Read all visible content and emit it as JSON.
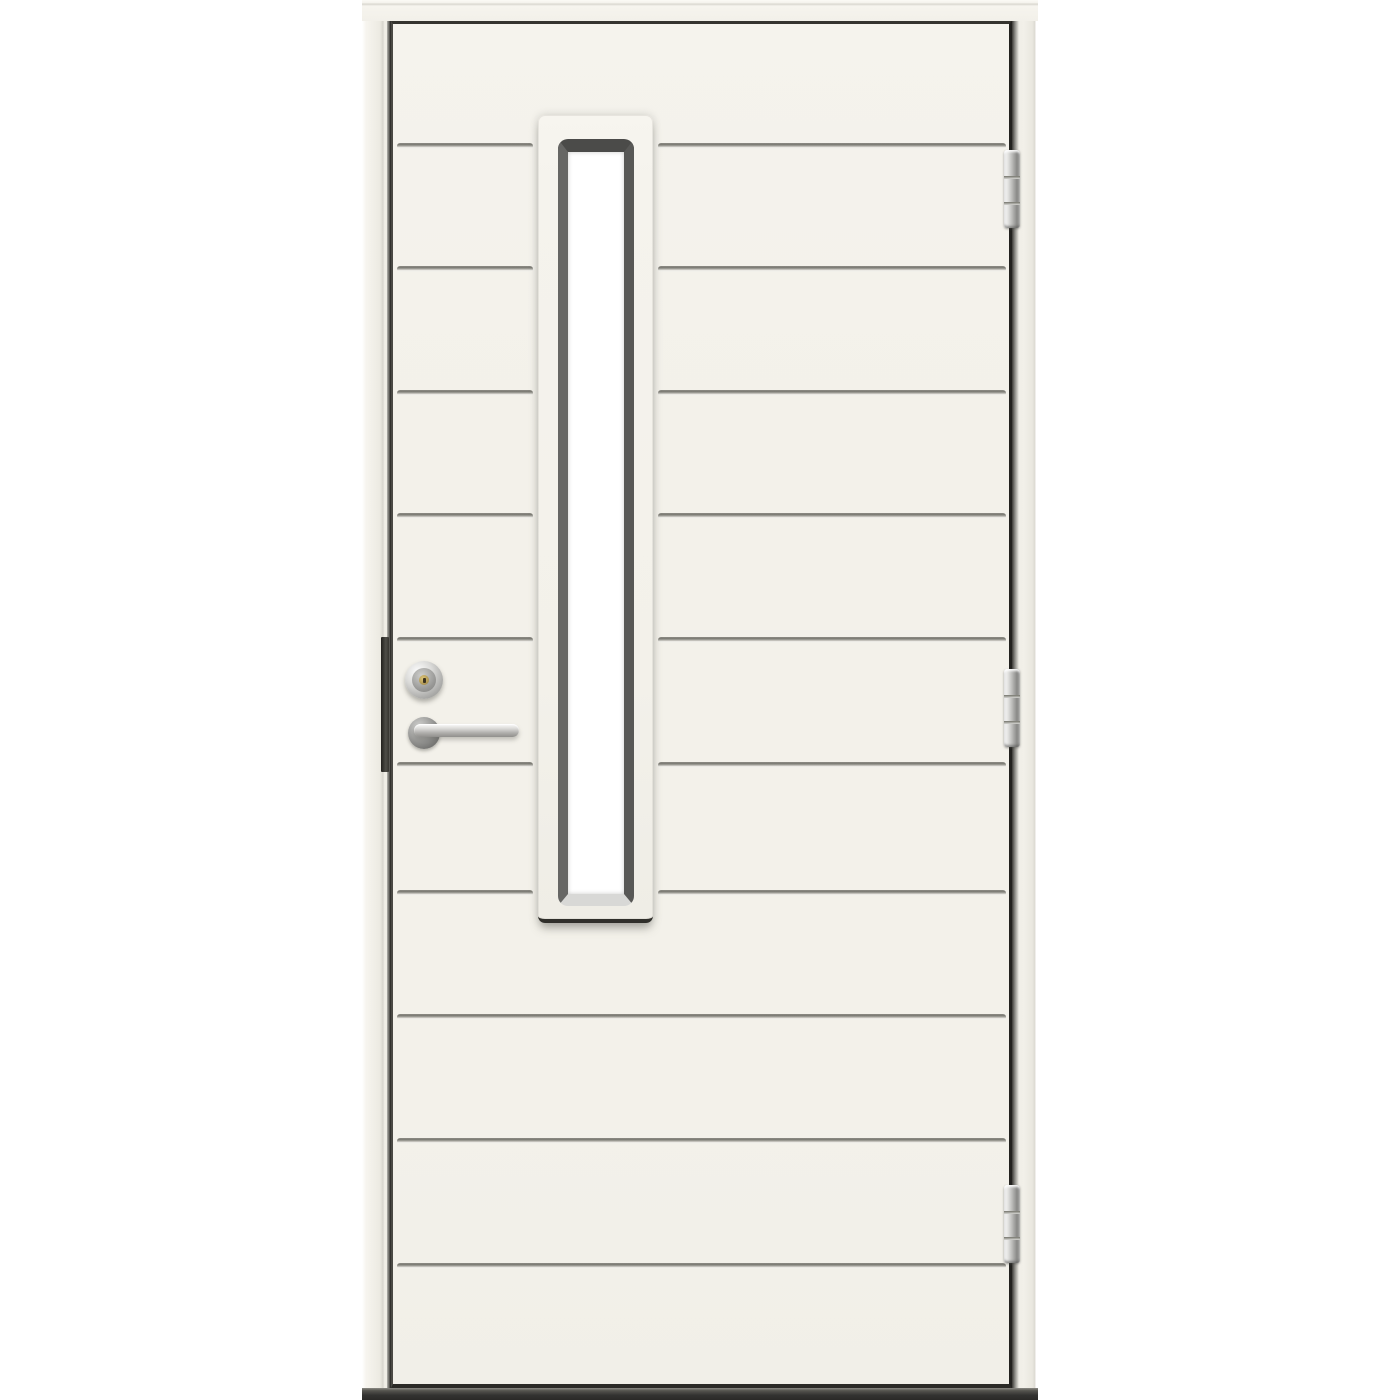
{
  "scene": {
    "description": "White exterior front door, front view: eleven horizontal grooved boards, tall narrow vertical glazing strip left of center, chrome lock cylinder and lever handle on the left side, three chrome barrel hinges on the right edge, cream door frame and dark threshold on white background",
    "background_color": "#ffffff"
  },
  "palette": {
    "background": "#ffffff",
    "door_face": "#f3f1ea",
    "door_face_shade": "#edebe4",
    "frame_face": "#f2f0e9",
    "frame_line": "#d8d6ce",
    "edge_dark": "#2e2d29",
    "gap_dark": "#1f1e1b",
    "groove_dark": "#7c7b74",
    "groove_light": "#f8f7f2",
    "surround_face": "#f5f3ed",
    "surround_edge_dark": "#302f2b",
    "bevel_top": "#4b4b49",
    "bevel_left": "#666664",
    "bevel_right": "#585856",
    "bevel_bottom": "#d8d8d6",
    "glass": "#ffffff",
    "chrome_hi": "#fbfbfb",
    "chrome_mid": "#b4b4b2",
    "chrome_dark": "#8a8a88",
    "rosette_dark": "#767674",
    "brass": "#b39a55",
    "keyhole_dark": "#3a3220",
    "threshold_dark": "#2a2927",
    "threshold_mid": "#55544f"
  },
  "door": {
    "frame_head": {
      "x": 362,
      "y": 0,
      "width": 676,
      "height": 21
    },
    "frame_left": {
      "x": 362,
      "y": 0,
      "width": 29,
      "height": 1400
    },
    "frame_right": {
      "x": 1012,
      "y": 0,
      "width": 26,
      "height": 1400
    },
    "threshold": {
      "x": 362,
      "y": 1388,
      "width": 676,
      "height": 12
    },
    "leaf": {
      "x": 391,
      "y": 21,
      "width": 621,
      "height": 1367
    },
    "board_count": 11,
    "groove_ys": [
      146,
      269,
      393,
      516,
      640,
      765,
      893,
      1017,
      1141,
      1266
    ],
    "groove_inset": 6,
    "groove_window_gap": 5,
    "window": {
      "surround": {
        "x": 538,
        "y": 115,
        "width": 115,
        "height": 808
      },
      "bevel": {
        "x": 558,
        "y": 139,
        "width": 76,
        "height": 767
      }
    },
    "hinge_template": {
      "x": 1004,
      "width": 16,
      "height": 78,
      "knuckle_offsets": [
        26,
        52
      ]
    },
    "hinges": [
      {
        "name": "hinge-top",
        "y": 150
      },
      {
        "name": "hinge-middle",
        "y": 669
      },
      {
        "name": "hinge-bottom",
        "y": 1185
      }
    ],
    "hardware": {
      "edge_plate": {
        "x": 381,
        "y": 637,
        "width": 8,
        "height": 135
      },
      "cylinder": {
        "x": 405,
        "y": 661,
        "width": 38,
        "height": 38
      },
      "rosette": {
        "x": 408,
        "y": 717,
        "width": 32,
        "height": 32
      },
      "lever": {
        "x": 414,
        "y": 724,
        "width": 105,
        "height": 13
      }
    }
  }
}
